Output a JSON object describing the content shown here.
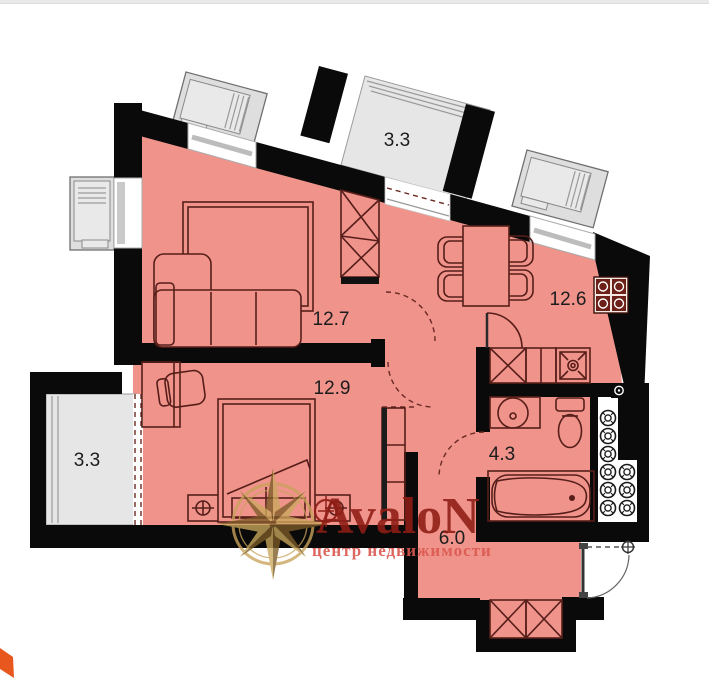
{
  "page": {
    "background": "#ffffff",
    "top_border": "#e9e9e9"
  },
  "watermark": {
    "brand": "AvaloN",
    "tagline": "центр недвижимости",
    "brand_color": "#8F1D15",
    "tagline_color": "#DB5B52",
    "compass_gold": "#C9A35B",
    "compass_brown": "#7B5B26"
  },
  "plan": {
    "wall_color": "#0a0a0a",
    "floor_color": "#EF938B",
    "balcony_color": "#E6E6E6",
    "furniture_line_color": "#571E19",
    "rooms": [
      {
        "id": "top-balcony",
        "label": "3.3"
      },
      {
        "id": "living-room",
        "label": "12.7"
      },
      {
        "id": "kitchen-living",
        "label": "12.6"
      },
      {
        "id": "bedroom",
        "label": "12.9"
      },
      {
        "id": "left-balcony",
        "label": "3.3"
      },
      {
        "id": "bathroom",
        "label": "4.3"
      },
      {
        "id": "hallway",
        "label": "6.0"
      }
    ]
  }
}
